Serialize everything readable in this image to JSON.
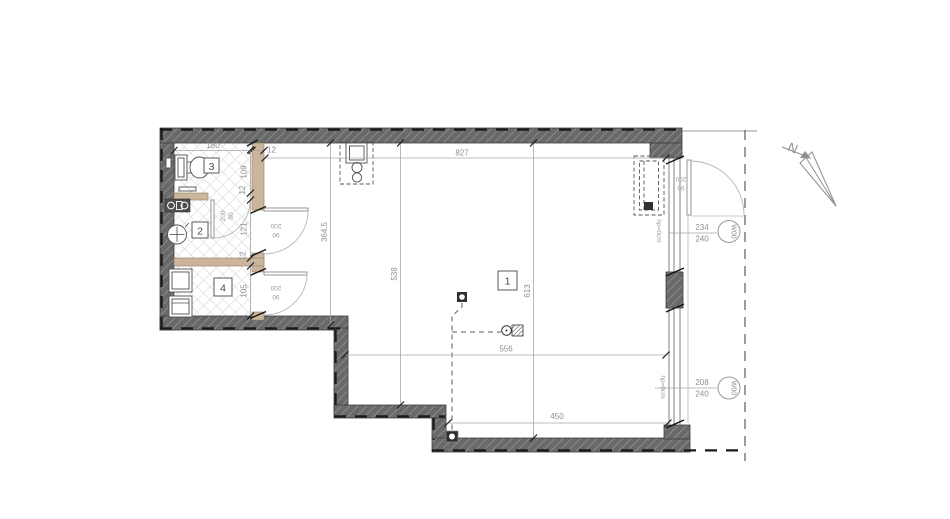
{
  "plan": {
    "rooms": {
      "r1": "1",
      "r2": "2",
      "r3": "3",
      "r4": "4"
    },
    "dims": {
      "top_room3": "180",
      "top_wall": "12",
      "top_total": "827",
      "left_room3": "109",
      "left_wall_a": "12",
      "left_room2": "121",
      "left_wall_b": "12",
      "left_room4": "105",
      "hall_height": "364.5",
      "main_left": "538",
      "main_right": "613",
      "bottom_inner": "556",
      "bottom_outer": "450"
    },
    "doors": {
      "room2": {
        "l1": "200",
        "l2": "90"
      },
      "room4": {
        "l1": "200",
        "l2": "90"
      },
      "balcony": {
        "l1": "200",
        "l2": "90"
      },
      "bath": {
        "l1": "200",
        "l2": "80"
      }
    },
    "windows": {
      "top": {
        "tag": "W00",
        "width": "234",
        "height": "240",
        "sill": "hp=0cm"
      },
      "bottom": {
        "tag": "W00",
        "width": "208",
        "height": "240",
        "sill": "hp=0cm"
      }
    },
    "north_label": "N",
    "colors": {
      "wall": "#696969",
      "partition": "#cbb59c",
      "dimension": "#8f8f8f"
    }
  }
}
